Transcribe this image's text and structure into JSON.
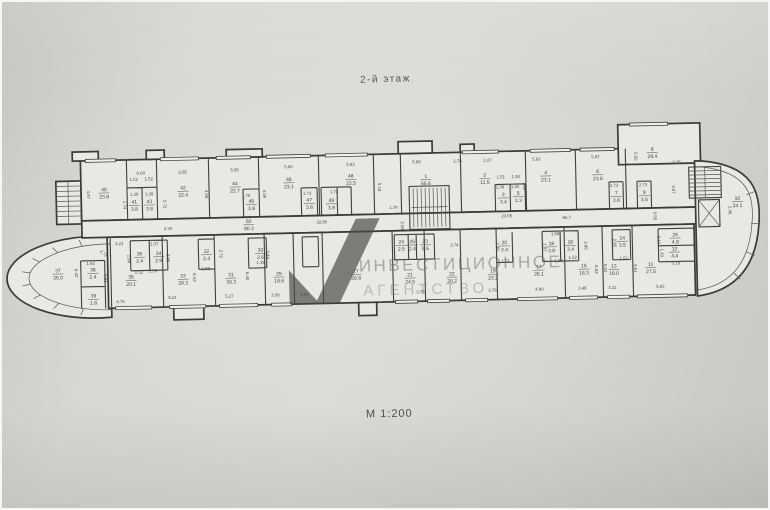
{
  "page": {
    "floor_title": "2-й этаж",
    "scale_label": "М 1:200"
  },
  "watermark": {
    "line1": "ИНВЕСТИЦИОННОЕ",
    "line2": "АГЕНТСТВО"
  },
  "colors": {
    "paper": "#d8d6d2",
    "room_fill": "#eae8e2",
    "wall_line": "#3f3d3a",
    "dim_text": "#4a4846",
    "watermark_logo": "#4b4a46",
    "watermark_text": "#6b6965"
  },
  "plan": {
    "rooms": [
      {
        "n": "40",
        "a": "23.8",
        "x": 103,
        "y": 184
      },
      {
        "n": "41",
        "a": "3.8",
        "x": 133,
        "y": 197
      },
      {
        "n": "43",
        "a": "3.8",
        "x": 148,
        "y": 197
      },
      {
        "n": "42",
        "a": "22.4",
        "x": 182,
        "y": 184
      },
      {
        "n": "44",
        "a": "22.7",
        "x": 234,
        "y": 181
      },
      {
        "n": "45",
        "a": "3.8",
        "x": 250,
        "y": 199
      },
      {
        "n": "46",
        "a": "23.1",
        "x": 288,
        "y": 178
      },
      {
        "n": "47",
        "a": "3.8",
        "x": 308,
        "y": 199
      },
      {
        "n": "49",
        "a": "3.8",
        "x": 330,
        "y": 200
      },
      {
        "n": "48",
        "a": "23.5",
        "x": 350,
        "y": 176
      },
      {
        "n": "1",
        "a": "55.6",
        "x": 425,
        "y": 178
      },
      {
        "n": "2",
        "a": "11.5",
        "x": 484,
        "y": 178
      },
      {
        "n": "3",
        "a": "3.4",
        "x": 502,
        "y": 198
      },
      {
        "n": "5",
        "a": "3.3",
        "x": 517,
        "y": 197
      },
      {
        "n": "4",
        "a": "23.1",
        "x": 545,
        "y": 177
      },
      {
        "n": "6",
        "a": "23.6",
        "x": 597,
        "y": 177
      },
      {
        "n": "7",
        "a": "3.8",
        "x": 615,
        "y": 199
      },
      {
        "n": "9",
        "a": "3.5",
        "x": 643,
        "y": 199
      },
      {
        "n": "8",
        "a": "28.4",
        "x": 652,
        "y": 156
      },
      {
        "n": "10",
        "a": "24.1",
        "x": 736,
        "y": 207
      },
      {
        "n": "50",
        "a": "80.3",
        "x": 247,
        "y": 219
      },
      {
        "n": "37",
        "a": "35.0",
        "x": 55,
        "y": 264
      },
      {
        "n": "38",
        "a": "2.4",
        "x": 90,
        "y": 264
      },
      {
        "n": "39",
        "a": "1.8",
        "x": 90,
        "y": 290
      },
      {
        "n": "35",
        "a": "20.1",
        "x": 128,
        "y": 272
      },
      {
        "n": "36",
        "a": "2.4",
        "x": 137,
        "y": 249
      },
      {
        "n": "34",
        "a": "2.9",
        "x": 156,
        "y": 249
      },
      {
        "n": "33",
        "a": "29.3",
        "x": 180,
        "y": 272
      },
      {
        "n": "32",
        "a": "2.4",
        "x": 204,
        "y": 248
      },
      {
        "n": "31",
        "a": "30.3",
        "x": 228,
        "y": 272
      },
      {
        "n": "30",
        "a": "2.6",
        "x": 258,
        "y": 248
      },
      {
        "n": "29",
        "a": "18.6",
        "x": 276,
        "y": 272
      },
      {
        "n": "27",
        "a": "29.8",
        "x": 353,
        "y": 271
      },
      {
        "n": "24",
        "a": "2.5",
        "x": 399,
        "y": 243
      },
      {
        "n": "25",
        "a": "2.4",
        "x": 410,
        "y": 243
      },
      {
        "n": "23",
        "a": "5.5",
        "x": 423,
        "y": 243
      },
      {
        "n": "21",
        "a": "24.5",
        "x": 407,
        "y": 276
      },
      {
        "n": "22",
        "a": "20.2",
        "x": 449,
        "y": 276
      },
      {
        "n": "19",
        "a": "23.2",
        "x": 490,
        "y": 274
      },
      {
        "n": "20",
        "a": "3.4",
        "x": 502,
        "y": 246
      },
      {
        "n": "17",
        "a": "26.1",
        "x": 536,
        "y": 271
      },
      {
        "n": "18",
        "a": "3.8",
        "x": 549,
        "y": 248
      },
      {
        "n": "16",
        "a": "3.4",
        "x": 568,
        "y": 247
      },
      {
        "n": "15",
        "a": "18.3",
        "x": 581,
        "y": 271
      },
      {
        "n": "14",
        "a": "3.5",
        "x": 620,
        "y": 244
      },
      {
        "n": "13",
        "a": "18.0",
        "x": 611,
        "y": 272
      },
      {
        "n": "26",
        "a": "4.8",
        "x": 673,
        "y": 242
      },
      {
        "n": "12",
        "a": "4.4",
        "x": 672,
        "y": 256
      },
      {
        "n": "11",
        "a": "27.5",
        "x": 648,
        "y": 271
      }
    ],
    "dims": [
      {
        "t": "6.09",
        "x": 140,
        "y": 167
      },
      {
        "t": "4.87",
        "x": 86,
        "y": 186,
        "r": 90
      },
      {
        "t": "1.52",
        "x": 133,
        "y": 173
      },
      {
        "t": "1.52",
        "x": 148,
        "y": 173
      },
      {
        "t": "1.39",
        "x": 133,
        "y": 188
      },
      {
        "t": "1.39",
        "x": 148,
        "y": 188
      },
      {
        "t": "1.74",
        "x": 122,
        "y": 197,
        "r": 90
      },
      {
        "t": "2.72",
        "x": 162,
        "y": 197,
        "r": 90
      },
      {
        "t": "5.85",
        "x": 182,
        "y": 167
      },
      {
        "t": "4.58",
        "x": 204,
        "y": 188,
        "r": 90
      },
      {
        "t": "5.85",
        "x": 234,
        "y": 166
      },
      {
        "t": "4.08",
        "x": 262,
        "y": 189,
        "r": 90
      },
      {
        "t": "5.80",
        "x": 288,
        "y": 164
      },
      {
        "t": "1.75",
        "x": 245,
        "y": 192
      },
      {
        "t": "5.82",
        "x": 350,
        "y": 163
      },
      {
        "t": "1.73",
        "x": 306,
        "y": 191
      },
      {
        "t": "1.73",
        "x": 333,
        "y": 190
      },
      {
        "t": "5.18",
        "x": 377,
        "y": 185,
        "r": 90
      },
      {
        "t": "1.78",
        "x": 392,
        "y": 207
      },
      {
        "t": "2.50",
        "x": 399,
        "y": 224,
        "r": 90
      },
      {
        "t": "5.99",
        "x": 416,
        "y": 162
      },
      {
        "t": "2.78",
        "x": 457,
        "y": 162
      },
      {
        "t": "3.27",
        "x": 487,
        "y": 162
      },
      {
        "t": "1.51",
        "x": 500,
        "y": 179
      },
      {
        "t": "1.50",
        "x": 515,
        "y": 179
      },
      {
        "t": "1.36",
        "x": 499,
        "y": 189
      },
      {
        "t": "1.40",
        "x": 514,
        "y": 189
      },
      {
        "t": "5.83",
        "x": 536,
        "y": 162
      },
      {
        "t": "4.47",
        "x": 522,
        "y": 188,
        "r": 90
      },
      {
        "t": "5.87",
        "x": 595,
        "y": 161
      },
      {
        "t": "2.73",
        "x": 613,
        "y": 190
      },
      {
        "t": "2.73",
        "x": 642,
        "y": 190
      },
      {
        "t": "5.50",
        "x": 634,
        "y": 160,
        "r": 90
      },
      {
        "t": "3.15",
        "x": 676,
        "y": 168
      },
      {
        "t": "3.07",
        "x": 671,
        "y": 194,
        "r": 90
      },
      {
        "t": "5.50",
        "x": 652,
        "y": 220,
        "r": 90
      },
      {
        "t": "2.46",
        "x": 727,
        "y": 216,
        "r": 90
      },
      {
        "t": "2.34",
        "x": 166,
        "y": 223
      },
      {
        "t": "32.85",
        "x": 320,
        "y": 220
      },
      {
        "t": "23.55",
        "x": 505,
        "y": 218
      },
      {
        "t": "60.7",
        "x": 565,
        "y": 221
      },
      {
        "t": "8.43",
        "x": 72,
        "y": 264,
        "r": 90
      },
      {
        "t": "1.62",
        "x": 88,
        "y": 256
      },
      {
        "t": "2.72",
        "x": 100,
        "y": 246,
        "r": 45
      },
      {
        "t": "3.21",
        "x": 117,
        "y": 237
      },
      {
        "t": "2.84",
        "x": 125,
        "y": 251,
        "r": 90
      },
      {
        "t": "1.52",
        "x": 136,
        "y": 266
      },
      {
        "t": "1.37",
        "x": 152,
        "y": 238
      },
      {
        "t": "2.85",
        "x": 164,
        "y": 251,
        "r": 90
      },
      {
        "t": "1.55",
        "x": 150,
        "y": 265
      },
      {
        "t": "3.91",
        "x": 101,
        "y": 270,
        "r": 90
      },
      {
        "t": "4.75",
        "x": 117,
        "y": 295
      },
      {
        "t": "6.43",
        "x": 190,
        "y": 271,
        "r": 90
      },
      {
        "t": "5.21",
        "x": 169,
        "y": 292
      },
      {
        "t": "1.55",
        "x": 203,
        "y": 264
      },
      {
        "t": "2.72",
        "x": 217,
        "y": 248,
        "r": 90
      },
      {
        "t": "6.40",
        "x": 243,
        "y": 271,
        "r": 90
      },
      {
        "t": "5.27",
        "x": 226,
        "y": 292
      },
      {
        "t": "1.39",
        "x": 258,
        "y": 259
      },
      {
        "t": "3.44",
        "x": 264,
        "y": 250,
        "r": 90
      },
      {
        "t": "3.58",
        "x": 272,
        "y": 292
      },
      {
        "t": "3.54",
        "x": 301,
        "y": 292
      },
      {
        "t": "3.74",
        "x": 452,
        "y": 246
      },
      {
        "t": "3.76",
        "x": 417,
        "y": 292
      },
      {
        "t": "3.76",
        "x": 489,
        "y": 292
      },
      {
        "t": "2.48",
        "x": 494,
        "y": 247,
        "r": 90
      },
      {
        "t": "1.51",
        "x": 503,
        "y": 263
      },
      {
        "t": "1.58",
        "x": 553,
        "y": 237
      },
      {
        "t": "2.87",
        "x": 541,
        "y": 249,
        "r": 90
      },
      {
        "t": "1.52",
        "x": 556,
        "y": 264
      },
      {
        "t": "4.80",
        "x": 536,
        "y": 292
      },
      {
        "t": "2.85",
        "x": 582,
        "y": 248,
        "r": 90
      },
      {
        "t": "1.52",
        "x": 570,
        "y": 261
      },
      {
        "t": "3.48",
        "x": 579,
        "y": 292
      },
      {
        "t": "6.63",
        "x": 592,
        "y": 272,
        "r": 90
      },
      {
        "t": "5.62",
        "x": 601,
        "y": 271,
        "r": 90
      },
      {
        "t": "2.85",
        "x": 611,
        "y": 246,
        "r": 90
      },
      {
        "t": "1.52",
        "x": 621,
        "y": 263
      },
      {
        "t": "3.11",
        "x": 609,
        "y": 292
      },
      {
        "t": "5.61",
        "x": 631,
        "y": 272,
        "r": 90
      },
      {
        "t": "5.83",
        "x": 657,
        "y": 292
      },
      {
        "t": "3.42",
        "x": 655,
        "y": 244,
        "r": 90
      },
      {
        "t": "1.43",
        "x": 658,
        "y": 257,
        "r": 90
      },
      {
        "t": "3.19",
        "x": 673,
        "y": 269
      }
    ]
  }
}
